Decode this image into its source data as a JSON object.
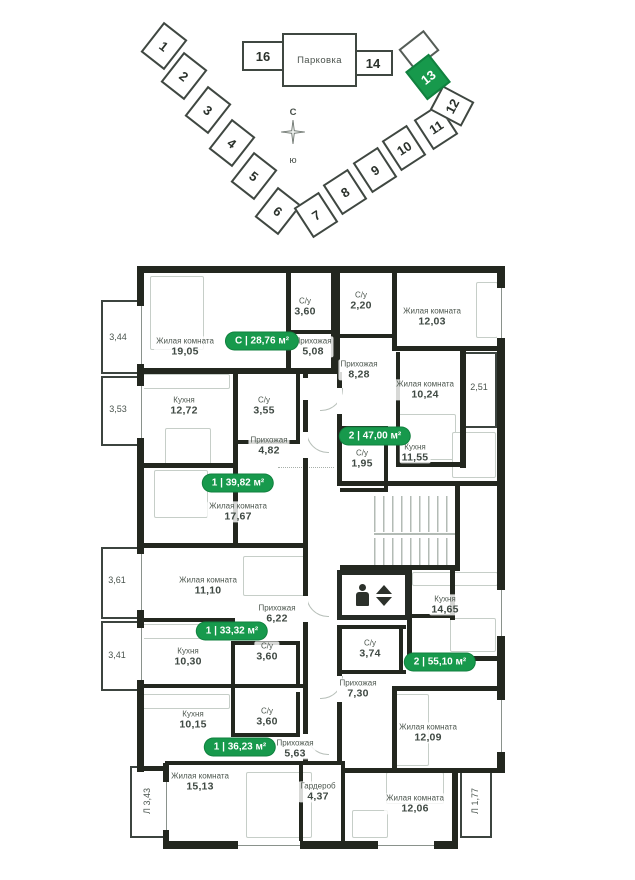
{
  "site_plan": {
    "parking_label": "Парковка",
    "compass": {
      "north": "С",
      "south": "ю"
    },
    "buildings": [
      "1",
      "2",
      "3",
      "4",
      "5",
      "6",
      "7",
      "8",
      "9",
      "10",
      "11",
      "12",
      "13",
      "14",
      "16"
    ],
    "highlighted_building": "13"
  },
  "floor_plan": {
    "badges": [
      "С | 28,76 м²",
      "1 | 39,82 м²",
      "2 | 47,00 м²",
      "1 | 33,32 м²",
      "1 | 36,23 м²",
      "2 | 55,10 м²"
    ],
    "rooms": [
      {
        "name": "Жилая комната",
        "area": "19,05"
      },
      {
        "name": "С/у",
        "area": "3,60"
      },
      {
        "name": "Прихожая",
        "area": "5,08"
      },
      {
        "name": "Кухня",
        "area": "12,72"
      },
      {
        "name": "С/у",
        "area": "3,55"
      },
      {
        "name": "Прихожая",
        "area": "4,82"
      },
      {
        "name": "Жилая комната",
        "area": "17,67"
      },
      {
        "name": "С/у",
        "area": "2,20"
      },
      {
        "name": "Жилая комната",
        "area": "12,03"
      },
      {
        "name": "Прихожая",
        "area": "8,28"
      },
      {
        "name": "Жилая комната",
        "area": "10,24"
      },
      {
        "name": "С/у",
        "area": "1,95"
      },
      {
        "name": "Кухня",
        "area": "11,55"
      },
      {
        "name": "Жилая комната",
        "area": "11,10"
      },
      {
        "name": "Прихожая",
        "area": "6,22"
      },
      {
        "name": "Кухня",
        "area": "10,30"
      },
      {
        "name": "С/у",
        "area": "3,60"
      },
      {
        "name": "Кухня",
        "area": "10,15"
      },
      {
        "name": "С/у",
        "area": "3,60"
      },
      {
        "name": "Прихожая",
        "area": "5,63"
      },
      {
        "name": "Жилая комната",
        "area": "15,13"
      },
      {
        "name": "Кухня",
        "area": "14,65"
      },
      {
        "name": "С/у",
        "area": "3,74"
      },
      {
        "name": "Прихожая",
        "area": "7,30"
      },
      {
        "name": "Жилая комната",
        "area": "12,09"
      },
      {
        "name": "Гардероб",
        "area": "4,37"
      },
      {
        "name": "Жилая комната",
        "area": "12,06"
      }
    ],
    "balconies": [
      "3,44",
      "3,53",
      "3,61",
      "3,41",
      "Л 3,43",
      "2,51",
      "Л 1,77"
    ]
  },
  "colors": {
    "accent_green": "#17994c",
    "wall_dark": "#23271f"
  }
}
